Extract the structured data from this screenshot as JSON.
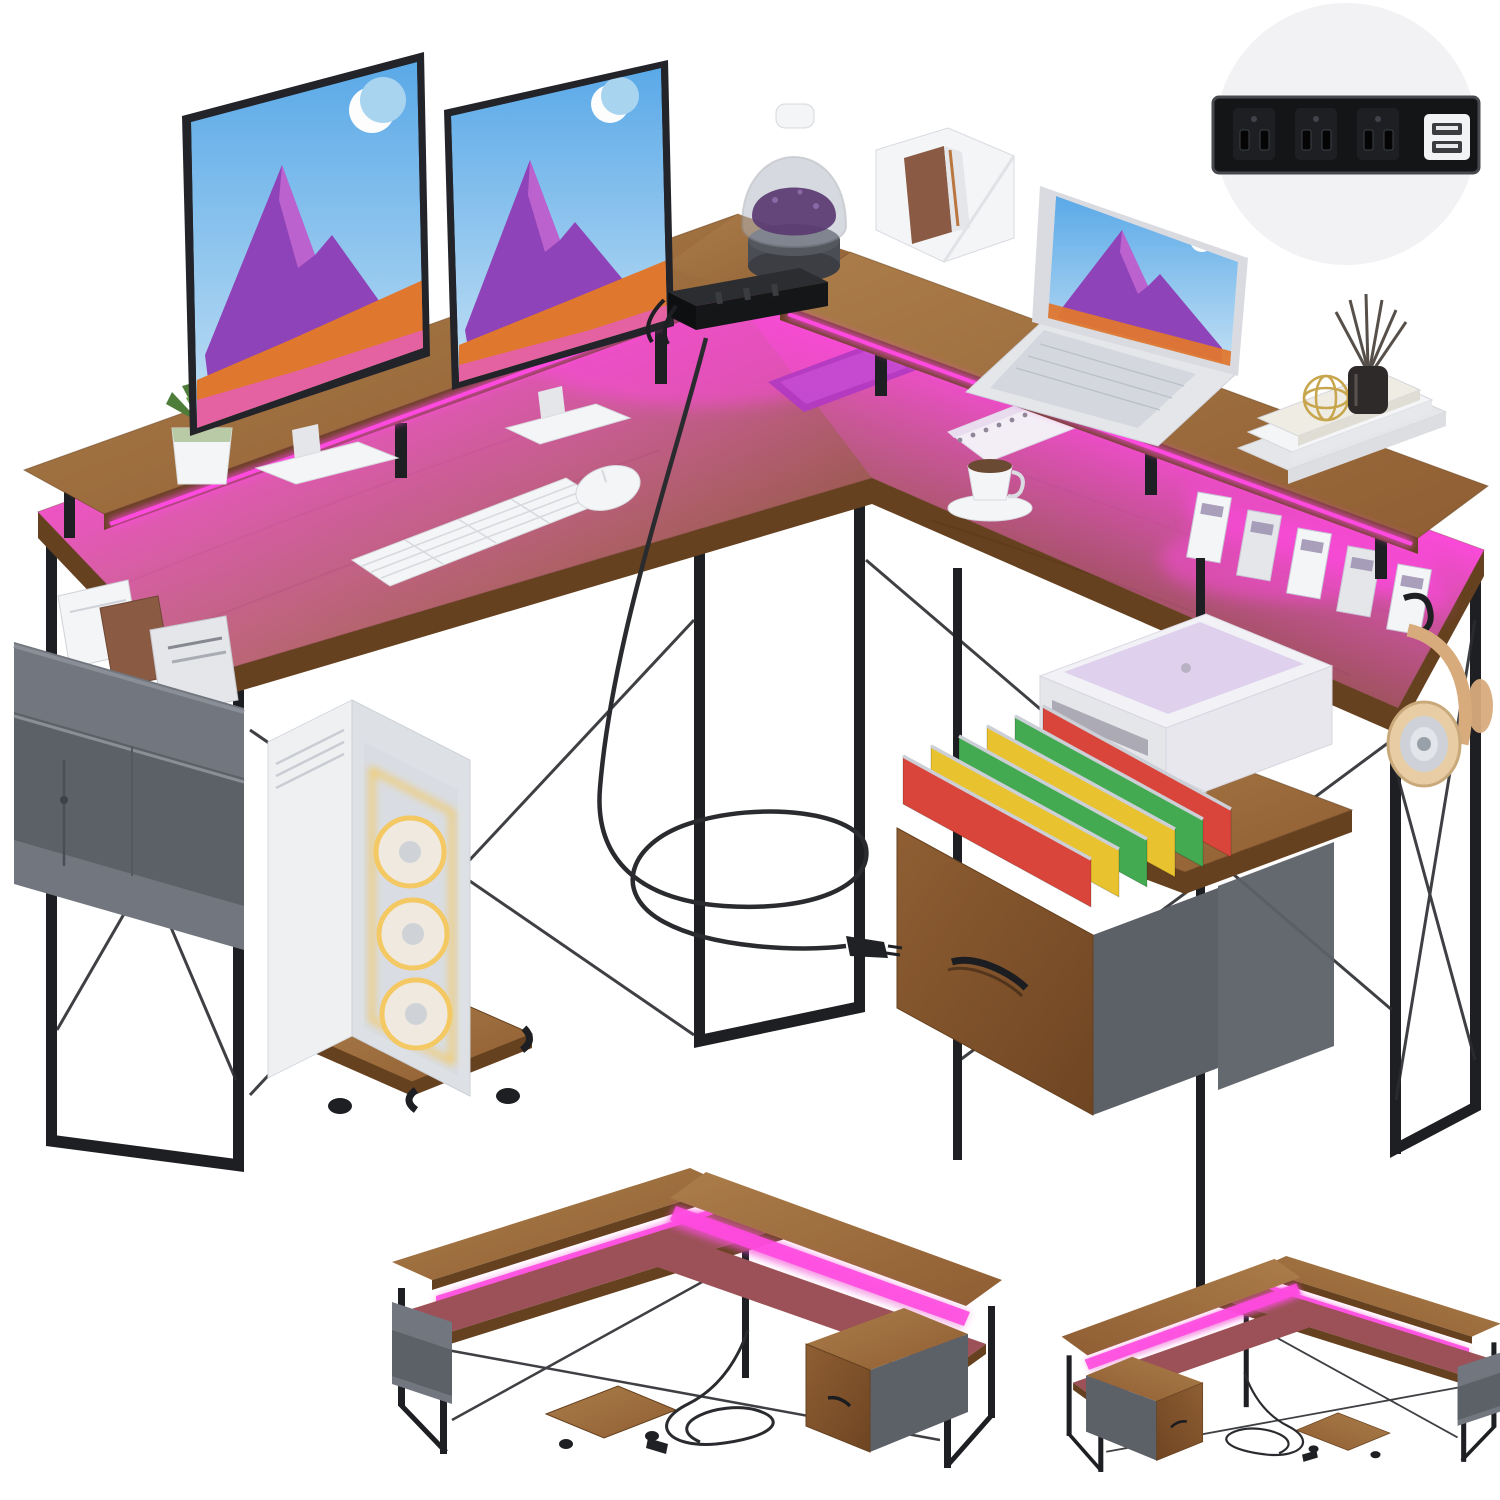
{
  "product_image": {
    "description_counts": {
      "monitor_count": 2,
      "laptop_count": 1,
      "rgb_fan_count": 3,
      "desk_variant_count": 2
    },
    "inset": {
      "outlet_count": 3,
      "usb_port_count": 2
    },
    "drawer": {
      "folder_colors": [
        "folderRed",
        "folderYellow",
        "folderGreen",
        "folderYellow",
        "folderGreen",
        "folderRed"
      ]
    }
  },
  "palette": {
    "bg": "#ffffff",
    "insetBg": "#f2f2f4",
    "stripBlack": "#141517",
    "stripEdge": "#47494e",
    "outletFace": "#1d1f22",
    "slotDark": "#050506",
    "slotEdge": "#3d4046",
    "usbWhite": "#f2f3f5",
    "usbSlot": "#3a3c40",
    "frame": "#1e1f22",
    "frameThin": "#2b2c30",
    "wood1": "#ab7d49",
    "wood2": "#7c5128",
    "woodEdge": "#66411f",
    "drawerWood1": "#8f5e33",
    "drawerWood2": "#6e4522",
    "ledHot": "#ff4ae0",
    "ledMid": "#e654c8",
    "fabric1": "#72767e",
    "fabric2": "#5c6067",
    "fabric3": "#8a8e96",
    "white1": "#f4f5f7",
    "white2": "#e4e6ea",
    "gray1": "#c9ccd3",
    "sky1": "#5aa9e8",
    "sky2": "#c2e0f4",
    "skyFlat": "#a8d4f0",
    "mtnPurple": "#8e44b8",
    "mtnPurpleL": "#c86ad4",
    "hillOrange": "#e0772f",
    "fgPink": "#e45fae",
    "printerW": "#f2f1f5",
    "printerTint": "#d9c9ec",
    "printerGray": "#e9e7ee",
    "printerSlot": "#8e8a98",
    "folderRed": "#d9453a",
    "folderYellow": "#e8c22f",
    "folderGreen": "#43aa52",
    "railSilver": "#ccd0d6",
    "potGreen": "#b9cba6",
    "leaf1": "#4e7d3a",
    "leaf2": "#68a04b",
    "liquid": "#5a3a72",
    "glassTint": "#aeb4c0",
    "gold": "#c8a64e",
    "diffuserDark": "#2e2a29",
    "reed": "#57504a",
    "tan": "#d8ab7c",
    "tanDark": "#c9a87a",
    "cupSilver": "#ced2d8",
    "cupCore": "#9aa0a8",
    "coffee": "#6b4a33",
    "cordCol": "#2a2b2e",
    "caseW": "#eef0f2",
    "caseSide": "#dde1e6",
    "glassPane": "#d8dce1",
    "fanGlow": "#f4c963",
    "fanHub": "#cfd3d8",
    "handleBlack": "#1c1d20",
    "labelGray": "#9b8fb0",
    "grain": "#46280f"
  }
}
